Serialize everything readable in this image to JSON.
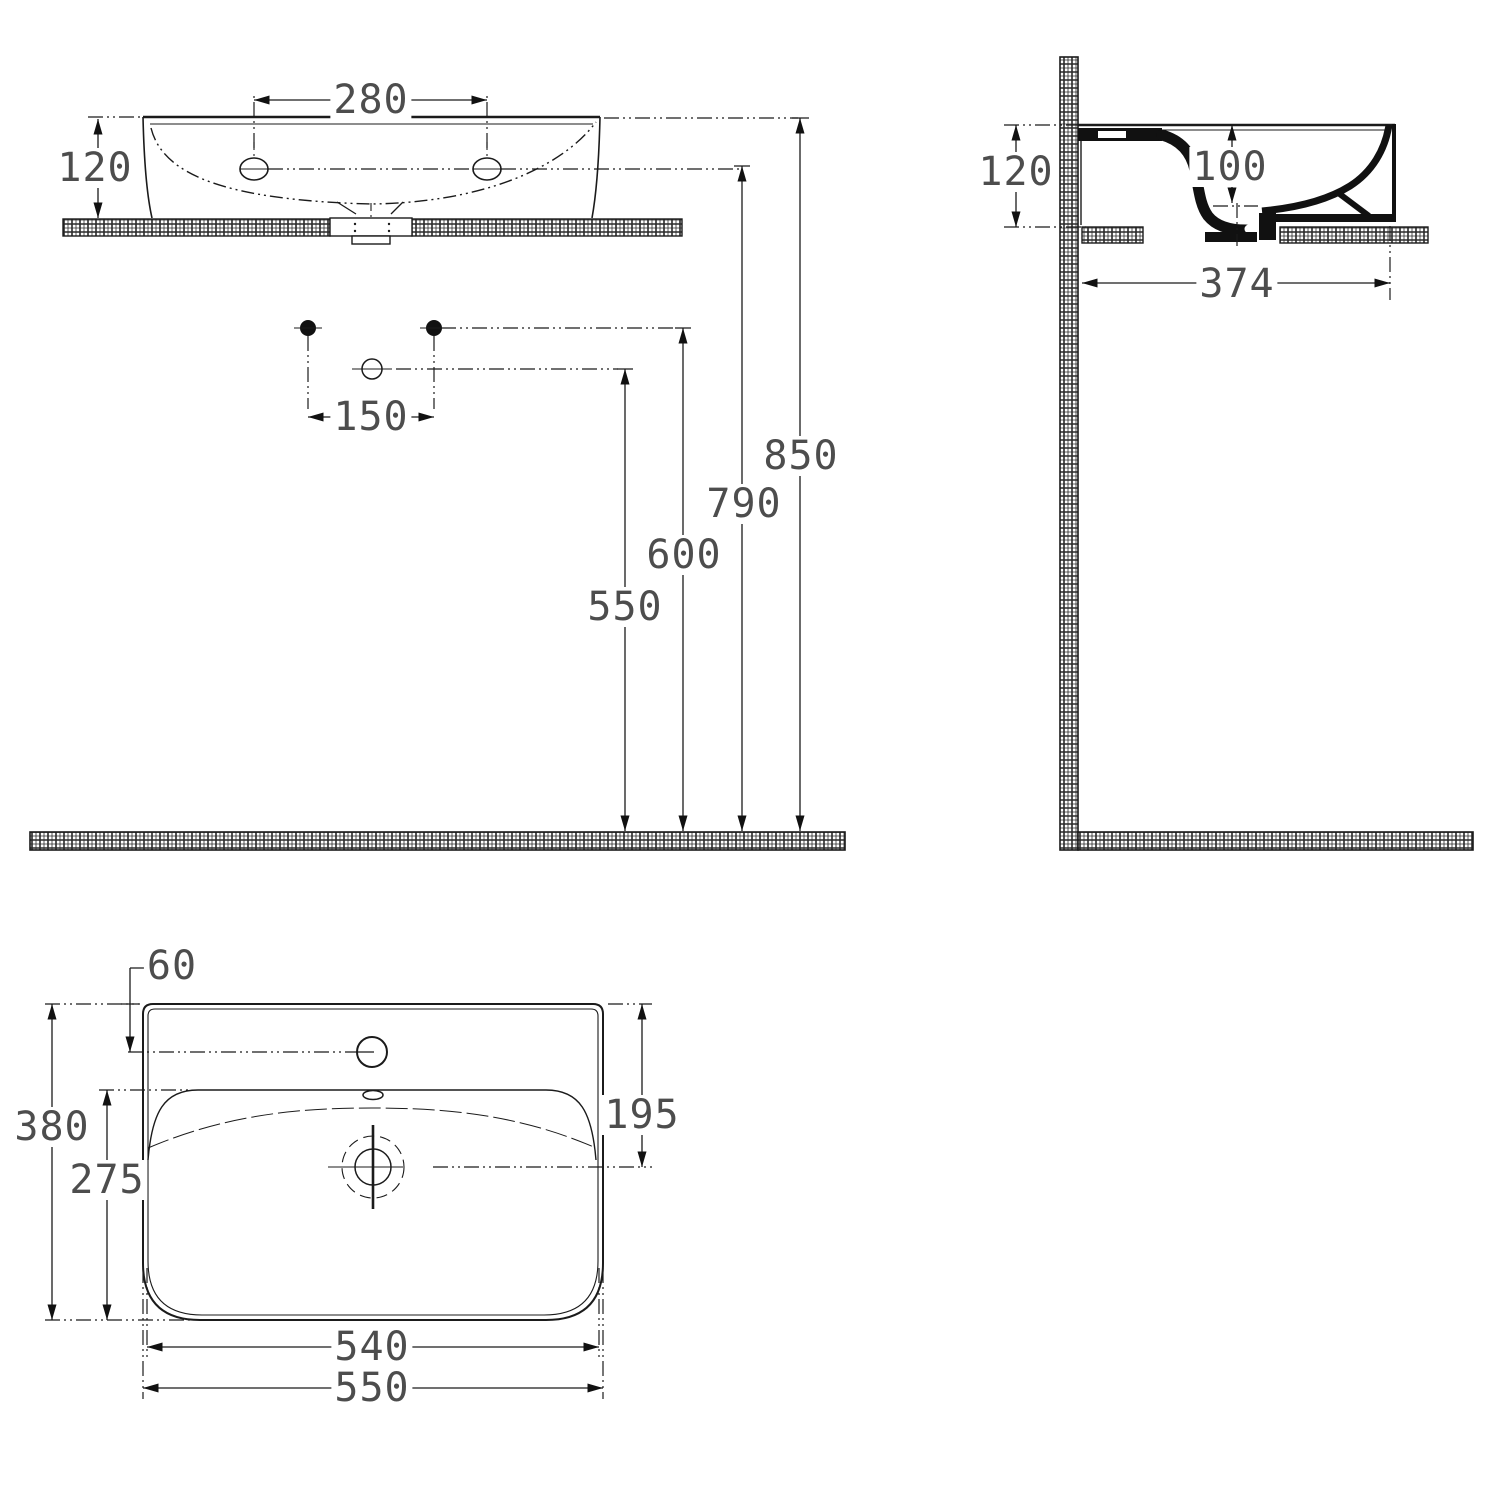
{
  "drawing": {
    "front": {
      "hole_spacing": "280",
      "rim_height_above_counter": "120",
      "tap_spacing": "150",
      "rim_height": "850",
      "hole_height": "790",
      "tap_height": "600",
      "spout_height": "550"
    },
    "side": {
      "rim_height_above_counter": "120",
      "bowl_depth": "100",
      "basin_projection": "374"
    },
    "plan": {
      "tap_offset": "60",
      "overall_depth": "380",
      "bowl_length": "275",
      "drain_offset": "195",
      "inner_width": "540",
      "overall_width": "550"
    }
  }
}
